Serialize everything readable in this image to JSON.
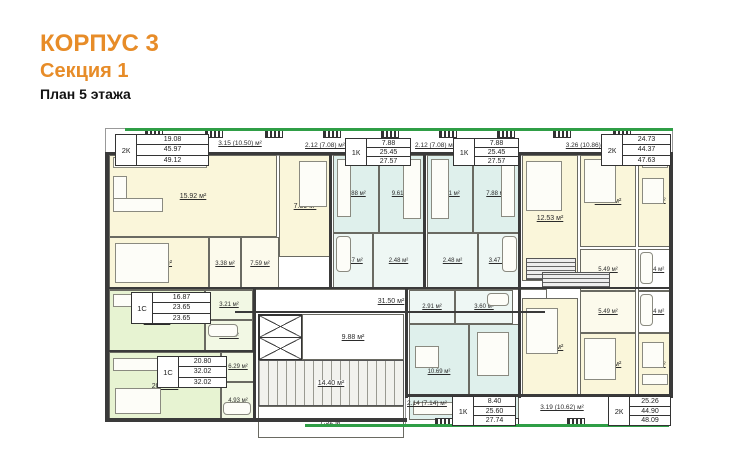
{
  "title": {
    "building": "КОРПУС 3",
    "section": "Секция 1",
    "plan": "План 5 этажа"
  },
  "colors": {
    "accent_orange": "#e78c28",
    "green_line": "#2f9e46",
    "wall": "#3a3a3a",
    "room_yellow": "#faf6da",
    "room_teal": "#dff0ec",
    "room_green": "#e7f3d2"
  },
  "legend_tables": [
    {
      "type": "2К",
      "living": "19.08",
      "total": "45.97",
      "total_balcony": "49.12"
    },
    {
      "type": "1К",
      "living": "7.88",
      "total": "25.45",
      "total_balcony": "27.57"
    },
    {
      "type": "1К",
      "living": "7.88",
      "total": "25.45",
      "total_balcony": "27.57"
    },
    {
      "type": "2К",
      "living": "24.73",
      "total": "44.37",
      "total_balcony": "47.63"
    },
    {
      "type": "1С",
      "living": "16.87",
      "total": "23.65",
      "total_balcony": "23.65"
    },
    {
      "type": "1С",
      "living": "20.80",
      "total": "32.02",
      "total_balcony": "32.02"
    },
    {
      "type": "1К",
      "living": "8.40",
      "total": "25.60",
      "total_balcony": "27.74"
    },
    {
      "type": "2К",
      "living": "25.26",
      "total": "44.90",
      "total_balcony": "48.09"
    }
  ],
  "balconies": {
    "b1": "3.15 (10.50) м²",
    "b2": "2.12 (7.08) м²",
    "b3": "2.12 (7.08) м²",
    "b4": "3.26 (10.86) м²",
    "b5": "2.14 (7.14) м²",
    "b6": "3.19 (10.62) м²"
  },
  "areas": {
    "a1_living": "15.92 м²",
    "a1_bed1": "7.39 м²",
    "a1_bed2": "11.69 м²",
    "a1_bath": "3.38 м²",
    "a1_hall": "7.59 м²",
    "a2_bed": "7.88 м²",
    "a2_kitchen": "9.61 м²",
    "a2_bath": "3.47 м²",
    "a2_hall": "2.48 м²",
    "a3_kitchen": "9.61 м²",
    "a3_bed": "7.88 м²",
    "a3_hall": "2.48 м²",
    "a3_bath": "3.47 м²",
    "a4_bed1": "12.53 м²",
    "a4_bed2": "12.20 м²",
    "a4_kitchen": "10.11 м²",
    "a4_hall": "5.49 м²",
    "a4_bath": "4.04 м²",
    "corridor": "31.50 м²",
    "elevator_hall": "9.88 м²",
    "stairs": "14.40 м²",
    "lobby": "7.92 м²",
    "a5_living": "16.87 м²",
    "a5_hall": "3.21 м²",
    "a5_bath": "3.57 м²",
    "a6_living": "20.80 м²",
    "a6_hall": "6.29 м²",
    "a6_bath": "4.93 м²",
    "a7_hall": "2.91 м²",
    "a7_bath": "3.60 м²",
    "a7_kitchen": "10.69 м²",
    "a7_bed": "8.40 м²",
    "a8_living": "13.06 м²",
    "a8_hall": "5.49 м²",
    "a8_bath": "4.04 м²",
    "a8_bed": "12.20 м²",
    "a8_kitchen": "10.11 м²"
  }
}
